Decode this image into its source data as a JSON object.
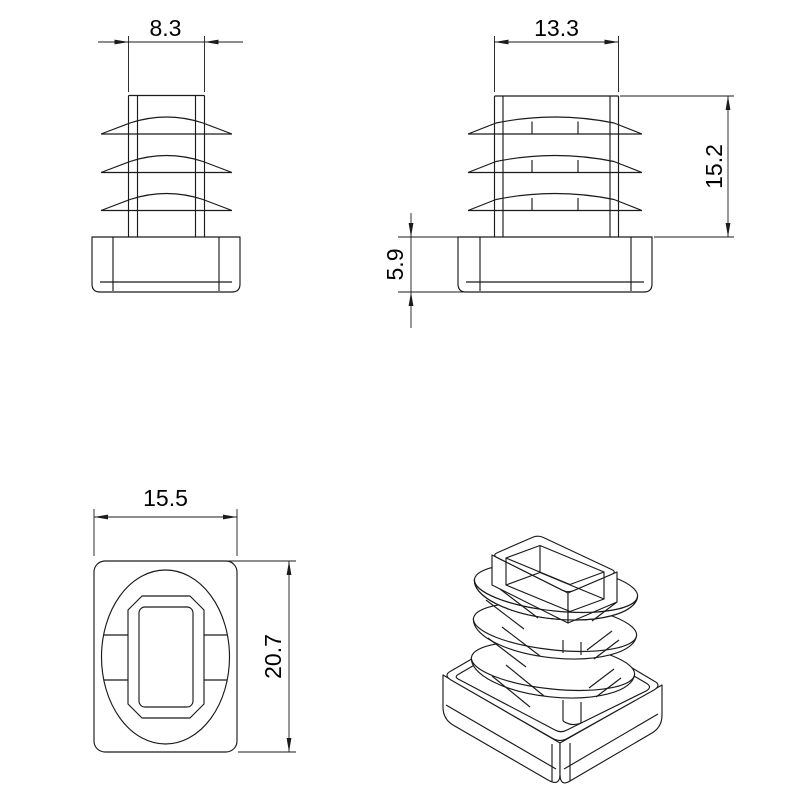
{
  "style": {
    "line_color": "#1b1b1b",
    "background": "#ffffff",
    "text_color": "#000000"
  },
  "labels": {
    "view_side_narrow": {
      "width": "8.3"
    },
    "view_side_wide": {
      "width": "13.3",
      "insert_depth": "15.2",
      "cap_height": "5.9"
    },
    "view_top": {
      "width": "15.5",
      "depth": "20.7"
    }
  }
}
